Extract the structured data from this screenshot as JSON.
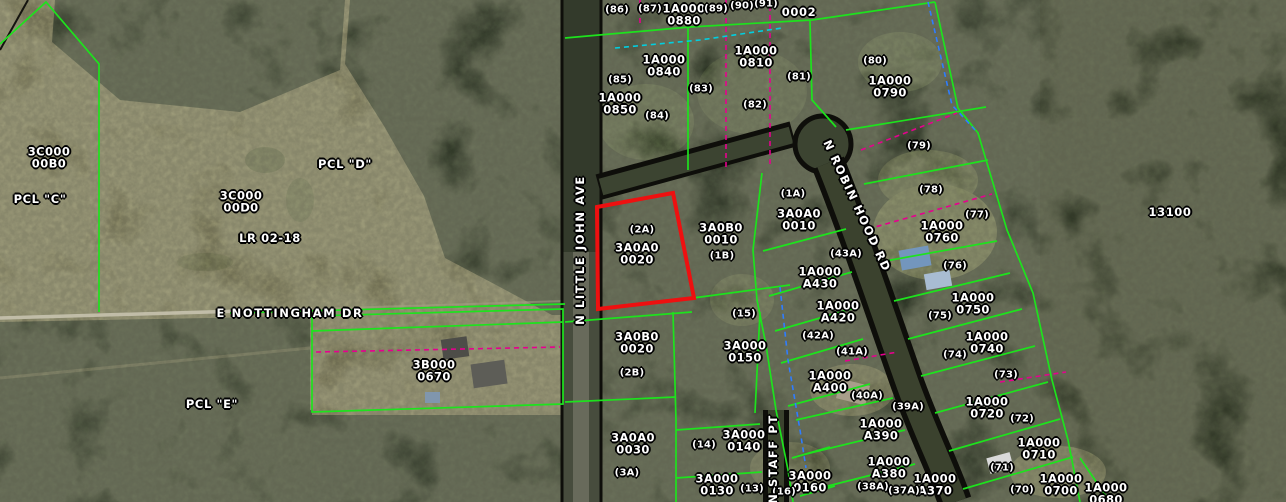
{
  "map_type": "gis-parcel-aerial-view",
  "colors": {
    "parcel_line": "#1de31d",
    "selected_outline": "#ee1010",
    "dashed_magenta": "#e6008e",
    "dashed_blue": "#2f7dff",
    "dashed_cyan": "#00cfe0",
    "label_text": "#ffffff"
  },
  "selected_parcel": {
    "id": "3A0A0 0020",
    "lot": "(2A)"
  },
  "road_labels": [
    {
      "text": "N LITTLE JOHN AVE",
      "x": 580,
      "y": 250,
      "rot": -90
    },
    {
      "text": "E NOTTINGHAM DR",
      "x": 290,
      "y": 313,
      "rot": 0
    },
    {
      "text": "N ROBIN HOOD RD",
      "x": 857,
      "y": 206,
      "rot": 65
    },
    {
      "text": "N STAFF PT",
      "x": 773,
      "y": 459,
      "rot": -90
    }
  ],
  "parcel_id_labels": [
    {
      "text": "1A000\n0880",
      "x": 684,
      "y": 15
    },
    {
      "text": "1A000\n0840",
      "x": 664,
      "y": 66
    },
    {
      "text": "1A000\n0850",
      "x": 620,
      "y": 104
    },
    {
      "text": "1A000\n0810",
      "x": 756,
      "y": 57
    },
    {
      "text": "1A000\n0790",
      "x": 890,
      "y": 87
    },
    {
      "text": "3A0A0\n0020",
      "x": 637,
      "y": 254
    },
    {
      "text": "3A0B0\n0010",
      "x": 721,
      "y": 234
    },
    {
      "text": "3A0A0\n0010",
      "x": 799,
      "y": 220
    },
    {
      "text": "1A000\nA430",
      "x": 820,
      "y": 278
    },
    {
      "text": "1A000\n0760",
      "x": 942,
      "y": 232
    },
    {
      "text": "1A000\n0750",
      "x": 973,
      "y": 304
    },
    {
      "text": "1A000\n0740",
      "x": 987,
      "y": 343
    },
    {
      "text": "1A000\nA420",
      "x": 838,
      "y": 312
    },
    {
      "text": "1A000\nA400",
      "x": 830,
      "y": 382
    },
    {
      "text": "3A0B0\n0020",
      "x": 637,
      "y": 343
    },
    {
      "text": "3A000\n0150",
      "x": 745,
      "y": 352
    },
    {
      "text": "3B000\n0670",
      "x": 434,
      "y": 371
    },
    {
      "text": "3A0A0\n0030",
      "x": 633,
      "y": 444
    },
    {
      "text": "3A000\n0140",
      "x": 744,
      "y": 441
    },
    {
      "text": "3A000\n0130",
      "x": 717,
      "y": 485
    },
    {
      "text": "3A000\n0160",
      "x": 810,
      "y": 482
    },
    {
      "text": "1A000\nA390",
      "x": 881,
      "y": 430
    },
    {
      "text": "1A000\nA380",
      "x": 889,
      "y": 468
    },
    {
      "text": "1A000\nA370",
      "x": 935,
      "y": 485
    },
    {
      "text": "1A000\n0720",
      "x": 987,
      "y": 408
    },
    {
      "text": "1A000\n0710",
      "x": 1039,
      "y": 449
    },
    {
      "text": "1A000\n0700",
      "x": 1061,
      "y": 485
    },
    {
      "text": "1A000\n0680",
      "x": 1106,
      "y": 494
    },
    {
      "text": "3C000\n00B0",
      "x": 49,
      "y": 158
    },
    {
      "text": "3C000\n00D0",
      "x": 241,
      "y": 202
    }
  ],
  "lot_labels": [
    {
      "text": "(86)",
      "x": 617,
      "y": 11
    },
    {
      "text": "(87)",
      "x": 650,
      "y": 10
    },
    {
      "text": "(89)",
      "x": 716,
      "y": 10
    },
    {
      "text": "(90)",
      "x": 742,
      "y": 7
    },
    {
      "text": "(91)",
      "x": 766,
      "y": 5
    },
    {
      "text": "(85)",
      "x": 620,
      "y": 81
    },
    {
      "text": "(84)",
      "x": 657,
      "y": 117
    },
    {
      "text": "(83)",
      "x": 701,
      "y": 90
    },
    {
      "text": "(82)",
      "x": 755,
      "y": 106
    },
    {
      "text": "(81)",
      "x": 799,
      "y": 78
    },
    {
      "text": "(80)",
      "x": 875,
      "y": 62
    },
    {
      "text": "(79)",
      "x": 919,
      "y": 147
    },
    {
      "text": "(78)",
      "x": 931,
      "y": 191
    },
    {
      "text": "(77)",
      "x": 977,
      "y": 216
    },
    {
      "text": "(76)",
      "x": 955,
      "y": 267
    },
    {
      "text": "(75)",
      "x": 940,
      "y": 317
    },
    {
      "text": "(74)",
      "x": 955,
      "y": 356
    },
    {
      "text": "(73)",
      "x": 1006,
      "y": 376
    },
    {
      "text": "(72)",
      "x": 1022,
      "y": 420
    },
    {
      "text": "(71)",
      "x": 1002,
      "y": 469
    },
    {
      "text": "(70)",
      "x": 1022,
      "y": 491
    },
    {
      "text": "(1A)",
      "x": 793,
      "y": 195
    },
    {
      "text": "(2A)",
      "x": 642,
      "y": 231
    },
    {
      "text": "(1B)",
      "x": 722,
      "y": 257
    },
    {
      "text": "(2B)",
      "x": 632,
      "y": 374
    },
    {
      "text": "(3A)",
      "x": 627,
      "y": 474
    },
    {
      "text": "(15)",
      "x": 744,
      "y": 315
    },
    {
      "text": "(14)",
      "x": 704,
      "y": 446
    },
    {
      "text": "(13)",
      "x": 752,
      "y": 490
    },
    {
      "text": "(16)",
      "x": 784,
      "y": 493
    },
    {
      "text": "(43A)",
      "x": 846,
      "y": 255
    },
    {
      "text": "(42A)",
      "x": 818,
      "y": 337
    },
    {
      "text": "(41A)",
      "x": 852,
      "y": 353
    },
    {
      "text": "(40A)",
      "x": 867,
      "y": 397
    },
    {
      "text": "(39A)",
      "x": 908,
      "y": 408
    },
    {
      "text": "(38A)",
      "x": 873,
      "y": 488
    },
    {
      "text": "(37A)",
      "x": 904,
      "y": 492
    }
  ],
  "area_labels": [
    {
      "text": "PCL \"C\"",
      "x": 40,
      "y": 199
    },
    {
      "text": "PCL \"D\"",
      "x": 345,
      "y": 164
    },
    {
      "text": "PCL \"E\"",
      "x": 212,
      "y": 404
    },
    {
      "text": "LR 02-18",
      "x": 270,
      "y": 238
    },
    {
      "text": "0002",
      "x": 799,
      "y": 12
    },
    {
      "text": "13100",
      "x": 1170,
      "y": 212
    }
  ]
}
